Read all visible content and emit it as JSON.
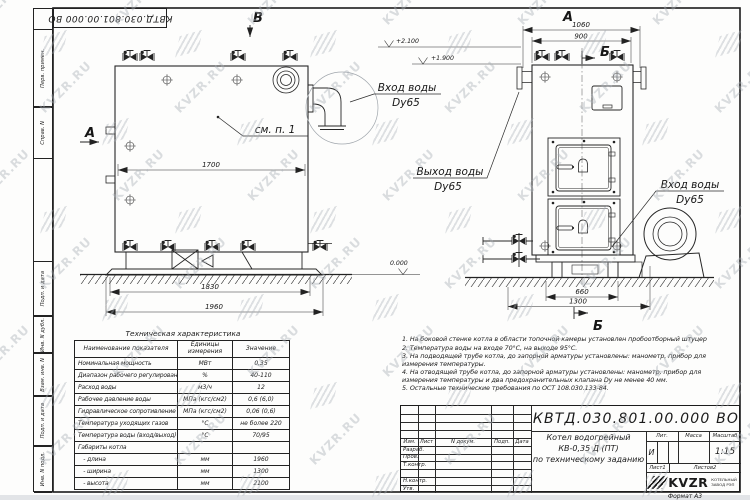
{
  "sheet": {
    "format_label": "Формат  А3"
  },
  "margin_labels": [
    "Перв. примен.",
    "Справ. N",
    "Подп. и дата",
    "Инв. N дубл.",
    "Взам. инв. N",
    "Подп. и дата",
    "Инв. N подл."
  ],
  "drawing": {
    "view_labels": {
      "a_left": "А",
      "a_top": "А",
      "b_top": "Б",
      "b_bottom": "Б",
      "v_top": "В"
    },
    "callouts": {
      "detail_ref": "см. п. 1",
      "inlet_left_l1": "Вход воды",
      "inlet_left_l2": "Dy65",
      "outlet_l1": "Выход воды",
      "outlet_l2": "Dy65",
      "inlet_right_l1": "Вход воды",
      "inlet_right_l2": "Dy65"
    },
    "elevations": {
      "top": "+2.100",
      "mid": "+1.900",
      "zero": "0.000"
    },
    "dimensions": {
      "d1700": "1700",
      "d1830": "1830",
      "d1960": "1960",
      "d1060": "1060",
      "d900": "900",
      "d660": "660",
      "d1300": "1300"
    }
  },
  "tech_table": {
    "title": "Техническая характеристика",
    "headers": [
      "Наименование показателя",
      "Единицы измерения",
      "Значение"
    ],
    "rows": [
      {
        "name": "Номинальная мощность",
        "unit": "МВт",
        "value": "0,35"
      },
      {
        "name": "Диапазон рабочего регулирования",
        "unit": "%",
        "value": "40-110"
      },
      {
        "name": "Расход воды",
        "unit": "м3/ч",
        "value": "12"
      },
      {
        "name": "Рабочее давление воды",
        "unit": "МПа (кгс/см2)",
        "value": "0,6 (6,0)"
      },
      {
        "name": "Гидравлическое сопротивление котла",
        "unit": "МПа (кгс/см2)",
        "value": "0,06 (0,6)"
      },
      {
        "name": "Температура уходящих газов",
        "unit": "°С",
        "value": "не более 220"
      },
      {
        "name": "Температура воды (вход/выход)",
        "unit": "°С",
        "value": "70/95"
      },
      {
        "name": "Габариты котла",
        "unit": "",
        "value": ""
      },
      {
        "name": "   - длина",
        "unit": "мм",
        "value": "1960"
      },
      {
        "name": "   - ширина",
        "unit": "мм",
        "value": "1300"
      },
      {
        "name": "   - высота",
        "unit": "мм",
        "value": "2100"
      }
    ]
  },
  "notes": [
    "1.  На боковой стенке котла в области топочной камеры установлен пробоотборный штуцер",
    "2.  Температура воды на входе 70°С, на выходе 95°С.",
    "3.  На подводящей трубе котла, до запорной арматуры установлены: манометр, прибор для измерения температуры.",
    "4.  На отводящей трубе котла, до запорной арматуры установлены: манометр, прибор для измерения температуры и два предохранительных клапана Dy не менее 40 мм.",
    "5.  Остальные технические требования по ОСТ 108.030.133-84."
  ],
  "title_block": {
    "doc_number": "КВТД.030.801.00.000 ВО",
    "product_name_lines": [
      "Котел водогрейный",
      "КВ-0,35 Д (ПТ)",
      "по техническому заданию"
    ],
    "change_header": [
      "Изм.",
      "Лист",
      "N докум.",
      "Подп.",
      "Дата"
    ],
    "signature_rows": [
      "Разраб.",
      "Пров.",
      "Т.контр.",
      "Н.контр.",
      "Утв."
    ],
    "lit_label": "Лит.",
    "lit_value": "И",
    "mass_label": "Масса",
    "scale_label": "Масштаб",
    "scale_value": "1:15",
    "sheet_label": "Лист",
    "sheet_value": "1",
    "sheets_label": "Листов",
    "sheets_value": "2",
    "company": {
      "logo_text": "KVZR",
      "sub_line1": "КОТЕЛЬНЫЙ",
      "sub_line2": "ЗАВОД РЭП"
    }
  },
  "watermark": {
    "text": "KVZR.RU"
  }
}
